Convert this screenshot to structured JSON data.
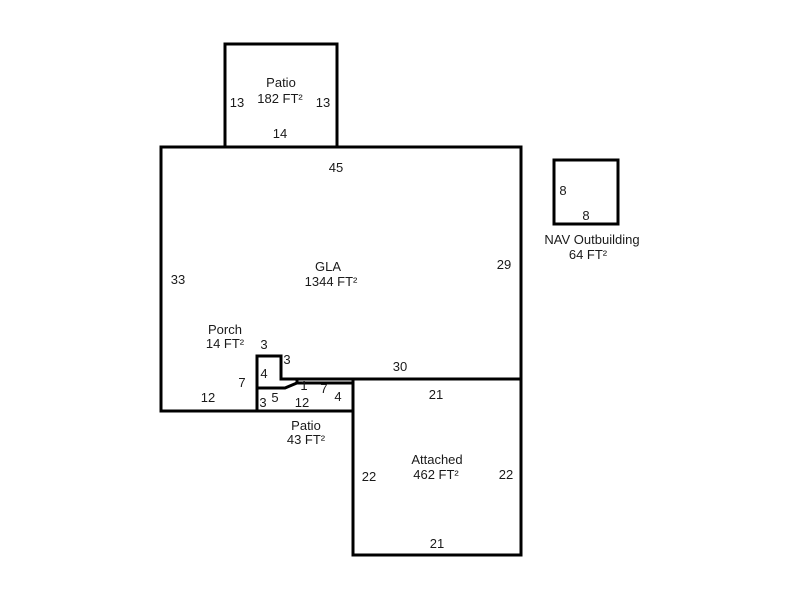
{
  "sketch": {
    "patio_top": {
      "label": "Patio",
      "area": "182 FT²",
      "dim_left": "13",
      "dim_right": "13",
      "dim_bottom": "14"
    },
    "gla": {
      "label": "GLA",
      "area": "1344 FT²",
      "dim_top": "45",
      "dim_left": "33",
      "dim_right": "29",
      "dim_bottom_right": "30",
      "dim_bottom_left": "12",
      "dim_porch_side": "7",
      "dim_notch_top": "3",
      "dim_notch_right": "3"
    },
    "porch": {
      "label": "Porch",
      "area": "14 FT²",
      "dim_inner": "4"
    },
    "patio_bottom": {
      "label": "Patio",
      "area": "43 FT²",
      "dim_left": "3",
      "dim_top_left": "5",
      "dim_step": "1",
      "dim_top_right": "7",
      "dim_right": "4",
      "dim_bottom": "12"
    },
    "attached": {
      "label": "Attached",
      "area": "462 FT²",
      "dim_top": "21",
      "dim_left": "22",
      "dim_right": "22",
      "dim_bottom": "21"
    },
    "outbuilding": {
      "label": "NAV Outbuilding",
      "area": "64 FT²",
      "dim_left": "8",
      "dim_bottom": "8"
    }
  },
  "colors": {
    "wall": "#000000",
    "text": "#1a1a1a",
    "background": "#ffffff"
  }
}
